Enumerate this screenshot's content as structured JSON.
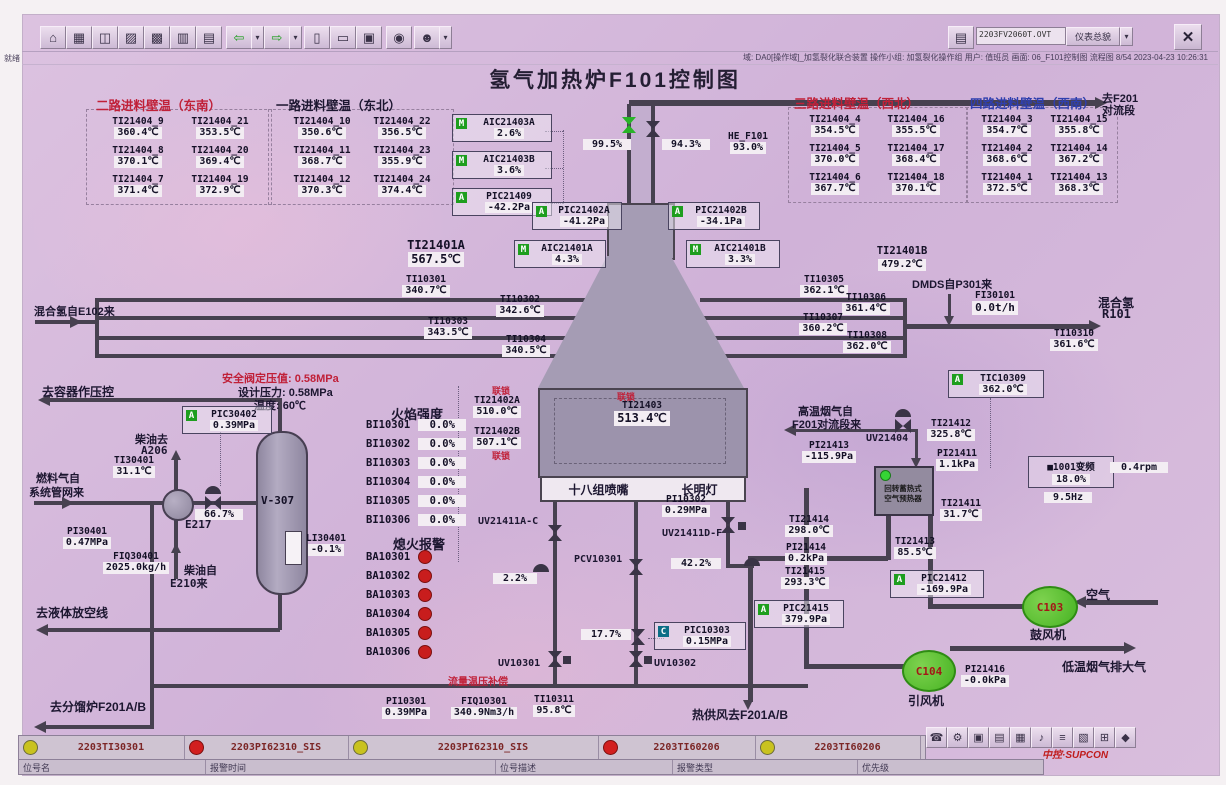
{
  "window": {
    "doc_field": "2203FV2060T.OVT",
    "panel_button": "仪表总貌",
    "dd": "▾",
    "close": "✕",
    "archive_icon": "▤",
    "ready": "就绪",
    "status_info": "域: DA0[操作域]_加氢裂化联合装置  操作小组: 加氢裂化操作组  用户: 值班员  画面: 06_F101控制图  流程图 8/54  2023-04-23 10:26:31"
  },
  "title": "氢气加热炉F101控制图",
  "toolbar": {
    "icons": [
      {
        "n": "home",
        "g": "⌂"
      },
      {
        "n": "overview",
        "g": "▦"
      },
      {
        "n": "window",
        "g": "◫"
      },
      {
        "n": "trend",
        "g": "▨"
      },
      {
        "n": "group",
        "g": "▩"
      },
      {
        "n": "detail",
        "g": "▥"
      },
      {
        "n": "report",
        "g": "▤"
      },
      {
        "n": "back",
        "g": "⇦"
      },
      {
        "n": "back-menu",
        "g": "▾"
      },
      {
        "n": "forward",
        "g": "⇨"
      },
      {
        "n": "forward-menu",
        "g": "▾"
      },
      {
        "n": "page-prev",
        "g": "▯"
      },
      {
        "n": "page-next",
        "g": "▭"
      },
      {
        "n": "book",
        "g": "▣"
      },
      {
        "n": "search",
        "g": "◉"
      },
      {
        "n": "user",
        "g": "☻"
      },
      {
        "n": "user-menu",
        "g": "▾"
      }
    ]
  },
  "wt": {
    "g1": {
      "h": "二路进料壁温（东南）"
    },
    "g2": {
      "h": "一路进料壁温（东北）"
    },
    "g3": {
      "h": "三路进料壁温（西北）"
    },
    "g4": {
      "h": "四路进料壁温（西南）"
    }
  },
  "i": {
    "TI21404_9": {
      "t": "TI21404_9",
      "v": "360.4℃"
    },
    "TI21404_21": {
      "t": "TI21404_21",
      "v": "353.5℃"
    },
    "TI21404_8": {
      "t": "TI21404_8",
      "v": "370.1℃"
    },
    "TI21404_20": {
      "t": "TI21404_20",
      "v": "369.4℃"
    },
    "TI21404_7": {
      "t": "TI21404_7",
      "v": "371.4℃"
    },
    "TI21404_19": {
      "t": "TI21404_19",
      "v": "372.9℃"
    },
    "TI21404_10": {
      "t": "TI21404_10",
      "v": "350.6℃"
    },
    "TI21404_22": {
      "t": "TI21404_22",
      "v": "356.5℃"
    },
    "TI21404_11": {
      "t": "TI21404_11",
      "v": "368.7℃"
    },
    "TI21404_23": {
      "t": "TI21404_23",
      "v": "355.9℃"
    },
    "TI21404_12": {
      "t": "TI21404_12",
      "v": "370.3℃"
    },
    "TI21404_24": {
      "t": "TI21404_24",
      "v": "374.4℃"
    },
    "TI21404_4": {
      "t": "TI21404_4",
      "v": "354.5℃"
    },
    "TI21404_16": {
      "t": "TI21404_16",
      "v": "355.5℃"
    },
    "TI21404_5": {
      "t": "TI21404_5",
      "v": "370.0℃"
    },
    "TI21404_17": {
      "t": "TI21404_17",
      "v": "368.4℃"
    },
    "TI21404_6": {
      "t": "TI21404_6",
      "v": "367.7℃"
    },
    "TI21404_18": {
      "t": "TI21404_18",
      "v": "370.1℃"
    },
    "TI21404_3": {
      "t": "TI21404_3",
      "v": "354.7℃"
    },
    "TI21404_15": {
      "t": "TI21404_15",
      "v": "355.8℃"
    },
    "TI21404_2": {
      "t": "TI21404_2",
      "v": "368.6℃"
    },
    "TI21404_14": {
      "t": "TI21404_14",
      "v": "367.2℃"
    },
    "TI21404_1": {
      "t": "TI21404_1",
      "v": "372.5℃"
    },
    "TI21404_13": {
      "t": "TI21404_13",
      "v": "368.3℃"
    },
    "AIC21403A": {
      "t": "AIC21403A",
      "v": "2.6%",
      "icon": "M"
    },
    "AIC21403B": {
      "t": "AIC21403B",
      "v": "3.6%",
      "icon": "M"
    },
    "PIC21409": {
      "t": "PIC21409",
      "v": "-42.2Pa",
      "icon": "A"
    },
    "PIC21402A": {
      "t": "PIC21402A",
      "v": "-41.2Pa",
      "icon": "A"
    },
    "PIC21402B": {
      "t": "PIC21402B",
      "v": "-34.1Pa",
      "icon": "A"
    },
    "AIC21401A": {
      "t": "AIC21401A",
      "v": "4.3%",
      "icon": "M"
    },
    "AIC21401B": {
      "t": "AIC21401B",
      "v": "3.3%",
      "icon": "M"
    },
    "HE_F101": {
      "t": "HE_F101",
      "v": "93.0%"
    },
    "TI21401A": {
      "t": "TI21401A",
      "v": "567.5℃"
    },
    "TI21401B": {
      "t": "TI21401B",
      "v": "479.2℃"
    },
    "TI10301": {
      "t": "TI10301",
      "v": "340.7℃"
    },
    "TI10302": {
      "t": "TI10302",
      "v": "342.6℃"
    },
    "TI10303": {
      "t": "TI10303",
      "v": "343.5℃"
    },
    "TI10304": {
      "t": "TI10304",
      "v": "340.5℃"
    },
    "TI10305": {
      "t": "TI10305",
      "v": "362.1℃"
    },
    "TI10306": {
      "t": "TI10306",
      "v": "361.4℃"
    },
    "TI10307": {
      "t": "TI10307",
      "v": "360.2℃"
    },
    "TI10308": {
      "t": "TI10308",
      "v": "362.0℃"
    },
    "TI10310": {
      "t": "TI10310",
      "v": "361.6℃"
    },
    "FI30101": {
      "t": "FI30101",
      "v": "0.0t/h"
    },
    "TIC10309": {
      "t": "TIC10309",
      "v": "362.0℃",
      "icon": "A"
    },
    "TI21402A": {
      "t": "TI21402A",
      "v": "510.0℃"
    },
    "TI21402B": {
      "t": "TI21402B",
      "v": "507.1℃"
    },
    "TI21403": {
      "t": "TI21403",
      "v": "513.4℃"
    },
    "BI10301": {
      "t": "BI10301",
      "v": "0.0%"
    },
    "BI10302": {
      "t": "BI10302",
      "v": "0.0%"
    },
    "BI10303": {
      "t": "BI10303",
      "v": "0.0%"
    },
    "BI10304": {
      "t": "BI10304",
      "v": "0.0%"
    },
    "BI10305": {
      "t": "BI10305",
      "v": "0.0%"
    },
    "BI10306": {
      "t": "BI10306",
      "v": "0.0%"
    },
    "BA10301": {
      "t": "BA10301"
    },
    "BA10302": {
      "t": "BA10302"
    },
    "BA10303": {
      "t": "BA10303"
    },
    "BA10304": {
      "t": "BA10304"
    },
    "BA10305": {
      "t": "BA10305"
    },
    "BA10306": {
      "t": "BA10306"
    },
    "PIC30402": {
      "t": "PIC30402",
      "v": "0.39MPa",
      "icon": "A"
    },
    "TI30401": {
      "t": "TI30401",
      "v": "31.1℃"
    },
    "PI30401": {
      "t": "PI30401",
      "v": "0.47MPa"
    },
    "FIQ30401": {
      "t": "FIQ30401",
      "v": "2025.0kg/h"
    },
    "LI30401": {
      "t": "LI30401",
      "v": "-0.1%"
    },
    "PI10302": {
      "t": "PI10302",
      "v": "0.29MPa"
    },
    "PIC10303": {
      "t": "PIC10303",
      "v": "0.15MPa",
      "icon": "C"
    },
    "PI10301": {
      "t": "PI10301",
      "v": "0.39MPa"
    },
    "FIQ10301": {
      "t": "FIQ10301",
      "v": "340.9Nm3/h"
    },
    "TI10311": {
      "t": "TI10311",
      "v": "95.8℃"
    },
    "TI21412": {
      "t": "TI21412",
      "v": "325.8℃"
    },
    "PI21413": {
      "t": "PI21413",
      "v": "-115.9Pa"
    },
    "PI21411": {
      "t": "PI21411",
      "v": "1.1kPa"
    },
    "TI21411": {
      "t": "TI21411",
      "v": "31.7℃"
    },
    "TI21414": {
      "t": "TI21414",
      "v": "298.0℃"
    },
    "PI21414": {
      "t": "PI21414",
      "v": "0.2kPa"
    },
    "TI21413": {
      "t": "TI21413",
      "v": "85.5℃"
    },
    "TI21415": {
      "t": "TI21415",
      "v": "293.3℃"
    },
    "PIC21412": {
      "t": "PIC21412",
      "v": "-169.9Pa",
      "icon": "A"
    },
    "PIC21415": {
      "t": "PIC21415",
      "v": "379.9Pa",
      "icon": "A"
    },
    "PI21416": {
      "t": "PI21416",
      "v": "-0.0kPa"
    }
  },
  "lb": {
    "e102": "混合氢自E102来",
    "tof201": "去F201",
    "duilv": "对流段",
    "dmds": "DMDS自P301来",
    "hunqing": "混合氢",
    "r101": "R101",
    "flame": "火焰强度",
    "mh": "熄火报警",
    "s1": "安全阀定压值: 0.58MPa",
    "s2": "设计压力: 0.58MPa",
    "s3": "温度: 60℃",
    "qurq": "去容器作压控",
    "cy1": "柴油去",
    "a206": "A206",
    "rq1": "燃料气自",
    "rq2": "系统管网来",
    "e217": "E217",
    "v307": "V-307",
    "cy2": "柴油自",
    "e210": "E210来",
    "drain": "去液体放空线",
    "tofl": "去分馏炉F201A/B",
    "burner": "十八组喷嘴",
    "pilot": "长明灯",
    "ls": "联锁",
    "fc": "流量温压补偿",
    "hot": "热供风去F201A/B",
    "gw1": "高温烟气自",
    "gw2": "F201对流段来",
    "ph1": "回转蓄热式",
    "ph2": "空气预热器",
    "gfj": "鼓风机",
    "yfj": "引风机",
    "air": "空气",
    "low": "低温烟气排大气",
    "c103": "C103",
    "c104": "C104",
    "uvac": "UV21411A-C",
    "uvdf": "UV21411D-F",
    "pcv": "PCV10301",
    "uv1": "UV10301",
    "uv2": "UV10302",
    "uv4": "UV21404",
    "p995": "99.5%",
    "p943": "94.3%",
    "p667": "66.7%",
    "p22": "2.2%",
    "p422": "42.2%",
    "p177": "17.7%"
  },
  "vfd": {
    "name": "■1001变频",
    "pct": "18.0%",
    "hz": "9.5Hz",
    "rpm": "0.4rpm"
  },
  "alarms": [
    {
      "tag": "2203TI30301",
      "level": "yellow"
    },
    {
      "tag": "2203PI62310_SIS",
      "level": "red"
    },
    {
      "tag": "2203PI62310_SIS",
      "level": "yellow"
    },
    {
      "tag": "2203TI60206",
      "level": "red"
    },
    {
      "tag": "2203TI60206",
      "level": "yellow"
    }
  ],
  "albl": [
    "位号名",
    "报警时间",
    "位号描述",
    "报警类型",
    "优先级"
  ],
  "logo": "中控·SUPCON",
  "boticons": [
    {
      "n": "phone",
      "g": "☎"
    },
    {
      "n": "gear",
      "g": "⚙"
    },
    {
      "n": "screen",
      "g": "▣"
    },
    {
      "n": "printer",
      "g": "▤"
    },
    {
      "n": "table",
      "g": "▦"
    },
    {
      "n": "media",
      "g": "♪"
    },
    {
      "n": "list",
      "g": "≡"
    },
    {
      "n": "doc",
      "g": "▧"
    },
    {
      "n": "grid",
      "g": "⊞"
    },
    {
      "n": "diamond",
      "g": "◆"
    }
  ],
  "palette": {
    "bg": "#d5bbdc",
    "pipe": "#474150",
    "value_box": "#f3edf3",
    "green": "#28b428",
    "red": "#c81d1d",
    "yellow": "#c9c21f",
    "furnace": "#a59cb4"
  }
}
